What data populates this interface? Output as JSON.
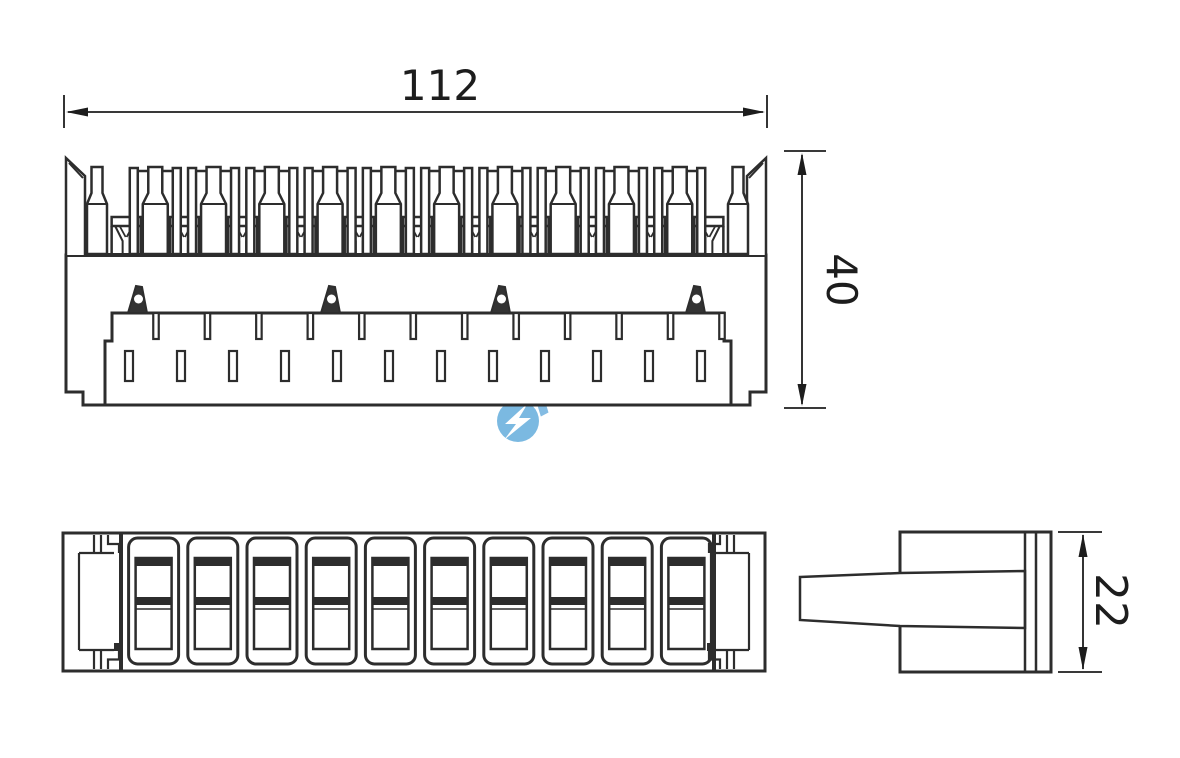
{
  "drawing": {
    "title": "terminal-block-technical-drawing",
    "background": "#ffffff",
    "line_color": "#2d2d2d",
    "dim_color": "#1d1d1d"
  },
  "dimensions": {
    "width_label": "112",
    "height_label": "40",
    "depth_label": "22"
  },
  "watermark": {
    "text": "HPXIN",
    "color": "#5ba8da",
    "text_color": "#66acdd",
    "logo_icon": "lightning-bolt-circle-icon"
  },
  "views": {
    "front": {
      "bottle_contacts": 12,
      "framed_contacts": 10,
      "funnel_contacts": 11,
      "latch_hooks": 4,
      "top_slots": 12,
      "mid_slots": 12
    },
    "plan": {
      "slots": 10
    },
    "side": {
      "layer_lines": 2
    }
  }
}
